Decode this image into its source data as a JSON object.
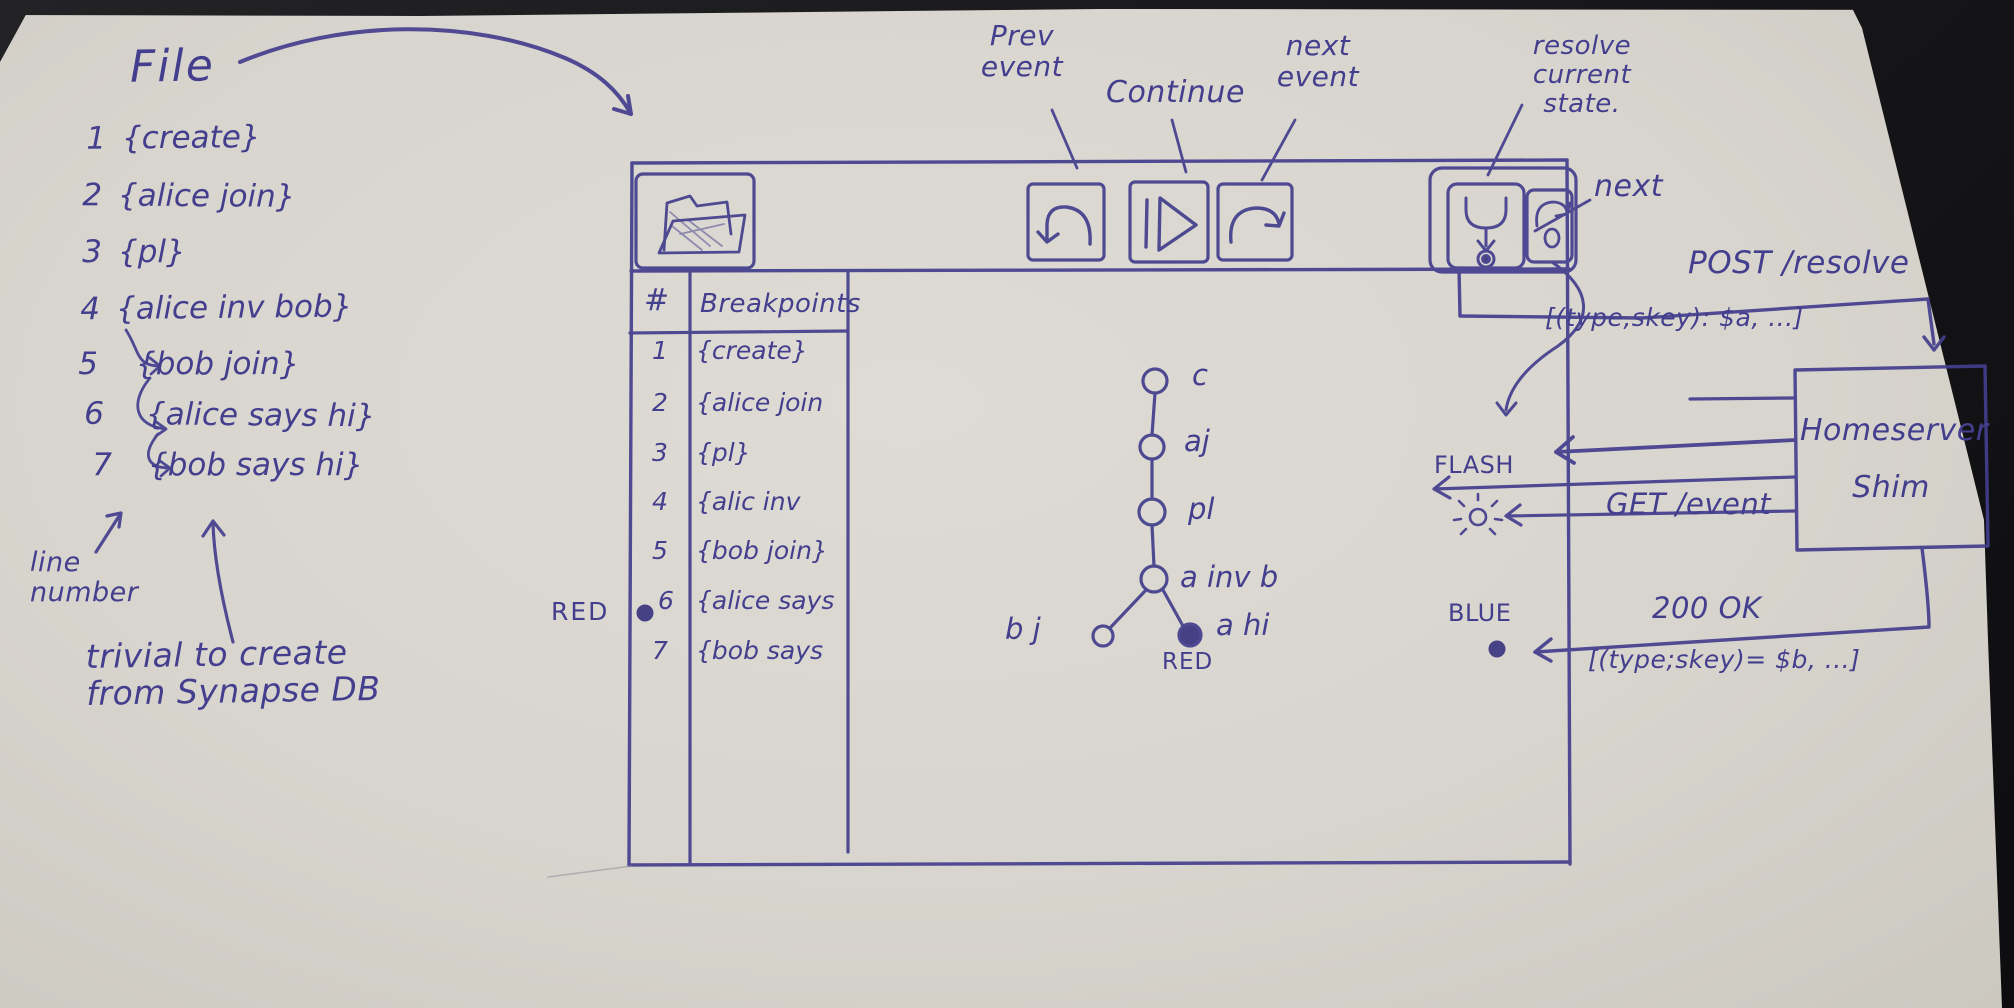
{
  "colors": {
    "ink": "#433e8d",
    "paper": "#d8d5ce",
    "background": "#141416"
  },
  "file_list": {
    "title": "File",
    "events": [
      {
        "num": "1",
        "text": "{create}"
      },
      {
        "num": "2",
        "text": "{alice join}"
      },
      {
        "num": "3",
        "text": "{pl}"
      },
      {
        "num": "4",
        "text": "{alice inv bob}"
      },
      {
        "num": "5",
        "text": "{bob join}"
      },
      {
        "num": "6",
        "text": "{alice says hi}"
      },
      {
        "num": "7",
        "text": "{bob says hi}"
      }
    ],
    "line_number_note": "line\nnumber",
    "trivial_note": "trivial to create\nfrom Synapse DB"
  },
  "debugger_window": {
    "toolbar": {
      "buttons": [
        {
          "icon": "open-folder-icon"
        },
        {
          "icon": "undo-arrow-icon",
          "label": "Prev\nevent"
        },
        {
          "icon": "play-pause-icon",
          "label": "Continue"
        },
        {
          "icon": "redo-arrow-icon",
          "label": "next\nevent"
        },
        {
          "icon": "merge-down-icon",
          "label": "resolve\ncurrent\nstate."
        },
        {
          "icon": "cycle-icon",
          "label": "next"
        }
      ]
    },
    "breakpoints_table": {
      "col_num_header": "#",
      "col_bp_header": "Breakpoints",
      "breakpoint_color_note": "RED",
      "rows": [
        {
          "num": "1",
          "text": "{create}",
          "breakpoint": false
        },
        {
          "num": "2",
          "text": "{alice join",
          "breakpoint": false
        },
        {
          "num": "3",
          "text": "{pl}",
          "breakpoint": false
        },
        {
          "num": "4",
          "text": "{alic inv",
          "breakpoint": false
        },
        {
          "num": "5",
          "text": "{bob join}",
          "breakpoint": false
        },
        {
          "num": "6",
          "text": "{alice says",
          "breakpoint": true
        },
        {
          "num": "7",
          "text": "{bob says",
          "breakpoint": false
        }
      ]
    },
    "dag": {
      "node_labels": [
        "c",
        "aj",
        "pl",
        "a inv b",
        "b j",
        "a hi"
      ],
      "red_node_note": "RED"
    }
  },
  "shim_flow": {
    "post_request": "POST /resolve",
    "post_payload": "[(type,skey): $a, ...]",
    "homeserver_box": "Homeserver\nShim",
    "get_request": "GET /event",
    "flash_note": "FLASH",
    "blue_note": "BLUE",
    "response": "200 OK",
    "response_payload": "[(type;skey)= $b, ...]"
  }
}
